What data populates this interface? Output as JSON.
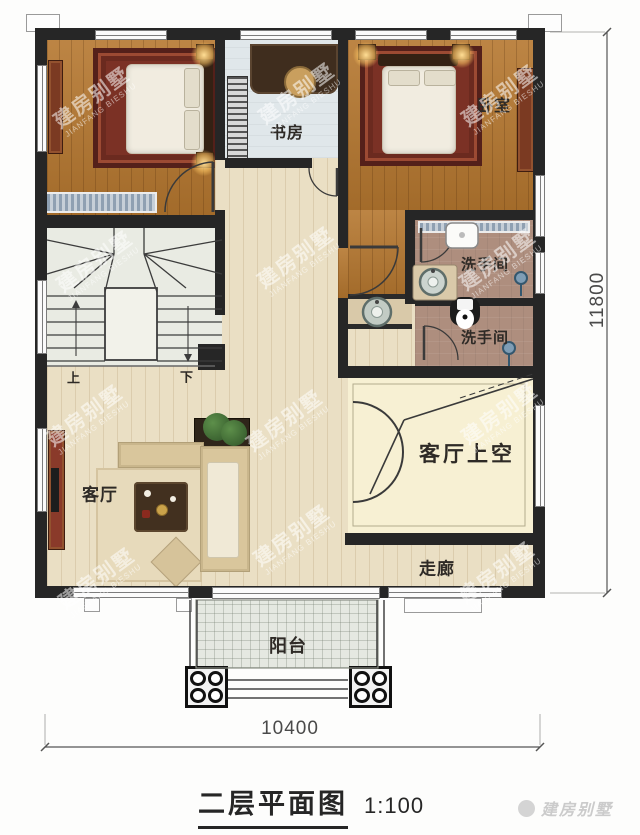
{
  "plan": {
    "rooms": {
      "study": {
        "label": "书房"
      },
      "bedroom": {
        "label": "卧室"
      },
      "washroom_upper": {
        "label": "洗手间"
      },
      "washroom_lower": {
        "label": "洗手间"
      },
      "living_room": {
        "label": "客厅"
      },
      "living_void": {
        "label": "客厅上空"
      },
      "corridor": {
        "label": "走廊"
      },
      "balcony": {
        "label": "阳台"
      }
    },
    "stairs": {
      "up_label": "上",
      "down_label": "下"
    },
    "dimensions": {
      "horizontal": "10400",
      "vertical": "11800"
    },
    "title": {
      "text": "二层平面图",
      "scale": "1:100"
    },
    "watermark": {
      "line1": "建房别墅",
      "line2": "JIANFANG BIESHU"
    },
    "corner_mark": {
      "text": "建房别墅"
    },
    "colors": {
      "wall": "#262626",
      "wood_floor": "#b5772f",
      "hall_floor": "#eadfc4",
      "bath_floor": "#ae8e7e",
      "void_floor": "#f7f0d3",
      "study_floor": "#e0e7ea",
      "stair_floor": "#e9ebe3",
      "balcony_floor": "#e5e8e1",
      "drain": "#7f9db5"
    }
  }
}
